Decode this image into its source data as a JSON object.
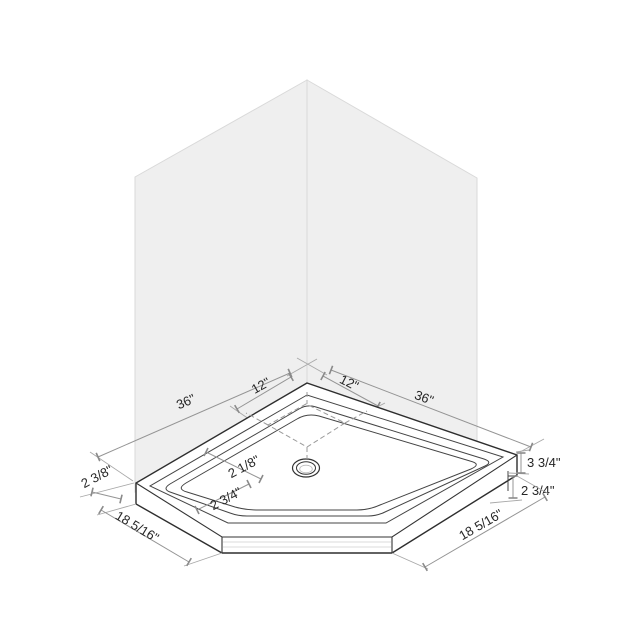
{
  "figure": {
    "kind": "isometric dimension drawing",
    "subject": "neo-angle corner shower base with back walls and center drain"
  },
  "colors": {
    "background": "#ffffff",
    "wall_fill": "#efefef",
    "wall_edge": "#d9d9d9",
    "pan_outline": "#2e2e2e",
    "dimension_line": "#949494",
    "label_text": "#262626"
  },
  "labels": {
    "wall_left_width": "36\"",
    "drain_offset_left": "12\"",
    "drain_offset_right": "12\"",
    "wall_right_width": "36\"",
    "rim_back_width": "2 1/8\"",
    "rim_front_width": "2 3/4\"",
    "corner_rim_width": "2 3/8\"",
    "front_left_edge": "18 5/16\"",
    "front_right_edge": "18 5/16\"",
    "total_height": "3 3/4\"",
    "step_height": "2 3/4\""
  }
}
